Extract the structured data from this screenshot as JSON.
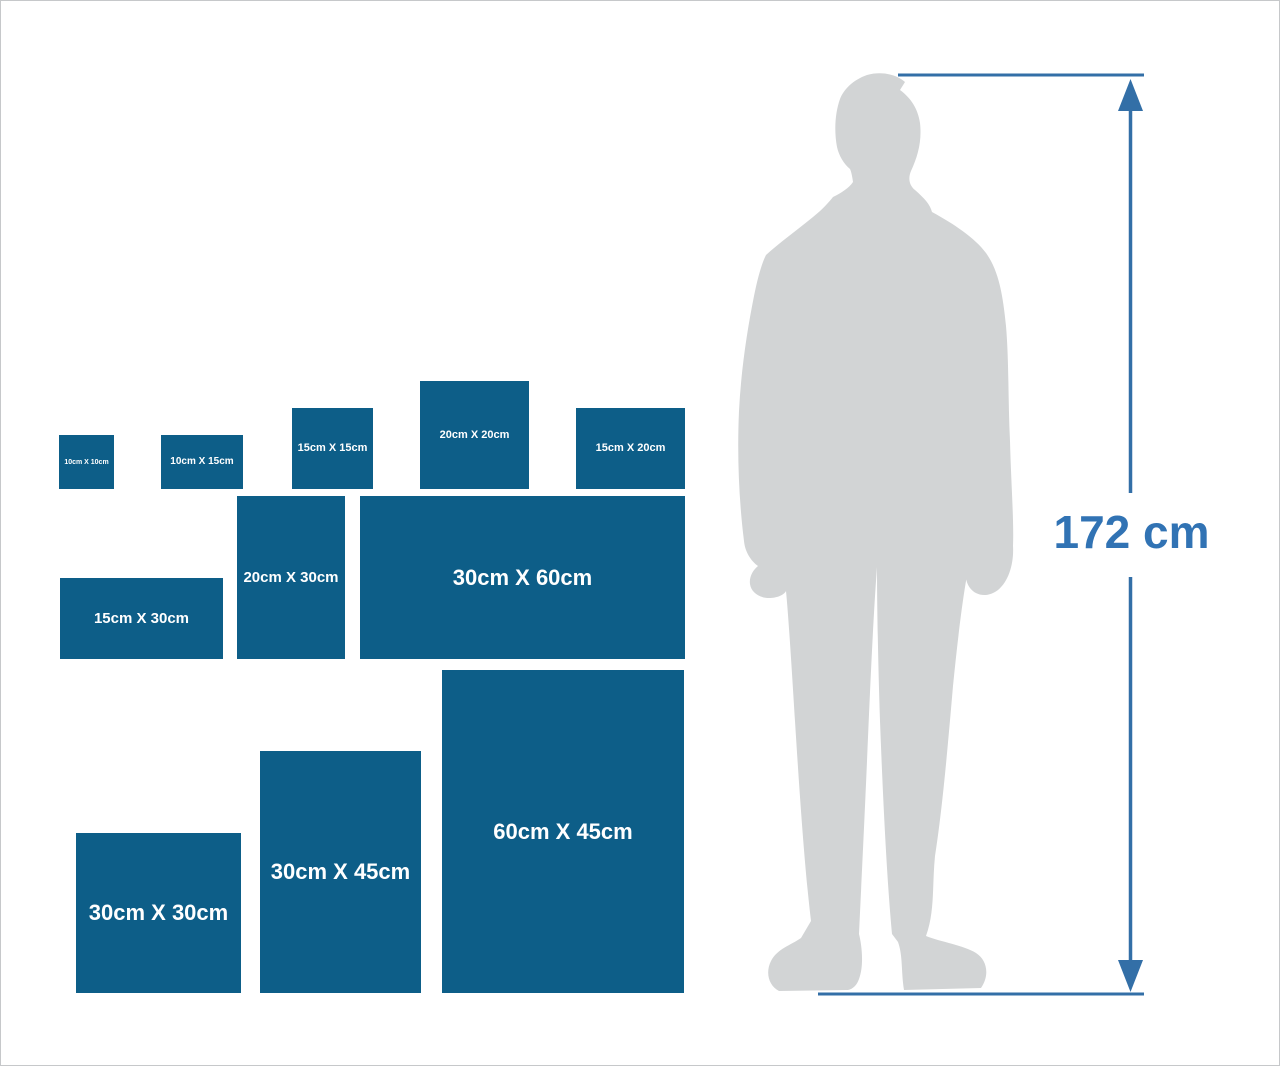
{
  "canvas": {
    "background": "#ffffff",
    "border_color": "#c6c8ca"
  },
  "palette": {
    "box_fill": "#0d5e88",
    "box_label": "#ffffff",
    "measure_line": "#336fa7",
    "measure_text": "#3173b4",
    "silhouette": "#d2d4d5"
  },
  "size_boxes": [
    {
      "id": "10cm-x-10cm",
      "label": "10cm X 10cm",
      "height_cm": 10,
      "width_cm": 10,
      "left": 58,
      "top": 434,
      "width": 55,
      "height": 54,
      "font_size": 7
    },
    {
      "id": "10cm-x-15cm",
      "label": "10cm X 15cm",
      "height_cm": 10,
      "width_cm": 15,
      "left": 160,
      "top": 434,
      "width": 82,
      "height": 54,
      "font_size": 10
    },
    {
      "id": "15cm-x-15cm",
      "label": "15cm X 15cm",
      "height_cm": 15,
      "width_cm": 15,
      "left": 291,
      "top": 407,
      "width": 81,
      "height": 81,
      "font_size": 11
    },
    {
      "id": "20cm-x-20cm",
      "label": "20cm X 20cm",
      "height_cm": 20,
      "width_cm": 20,
      "left": 419,
      "top": 380,
      "width": 109,
      "height": 108,
      "font_size": 11
    },
    {
      "id": "15cm-x-20cm",
      "label": "15cm X 20cm",
      "height_cm": 15,
      "width_cm": 20,
      "left": 575,
      "top": 407,
      "width": 109,
      "height": 81,
      "font_size": 11
    },
    {
      "id": "15cm-x-30cm",
      "label": "15cm X 30cm",
      "height_cm": 15,
      "width_cm": 30,
      "left": 59,
      "top": 577,
      "width": 163,
      "height": 81,
      "font_size": 15
    },
    {
      "id": "20cm-x-30cm",
      "label": "20cm X 30cm",
      "height_cm": 30,
      "width_cm": 20,
      "left": 236,
      "top": 495,
      "width": 108,
      "height": 163,
      "font_size": 15
    },
    {
      "id": "30cm-x-60cm",
      "label": "30cm X 60cm",
      "height_cm": 30,
      "width_cm": 60,
      "left": 359,
      "top": 495,
      "width": 325,
      "height": 163,
      "font_size": 22
    },
    {
      "id": "30cm-x-30cm",
      "label": "30cm X 30cm",
      "height_cm": 30,
      "width_cm": 30,
      "left": 75,
      "top": 832,
      "width": 165,
      "height": 160,
      "font_size": 22
    },
    {
      "id": "30cm-x-45cm",
      "label": "30cm X 45cm",
      "height_cm": 45,
      "width_cm": 30,
      "left": 259,
      "top": 750,
      "width": 161,
      "height": 242,
      "font_size": 22
    },
    {
      "id": "60cm-x-45cm",
      "label": "60cm X 45cm",
      "height_cm": 60,
      "width_cm": 45,
      "left": 441,
      "top": 669,
      "width": 242,
      "height": 323,
      "font_size": 22
    }
  ],
  "measurement": {
    "label": "172 cm"
  }
}
